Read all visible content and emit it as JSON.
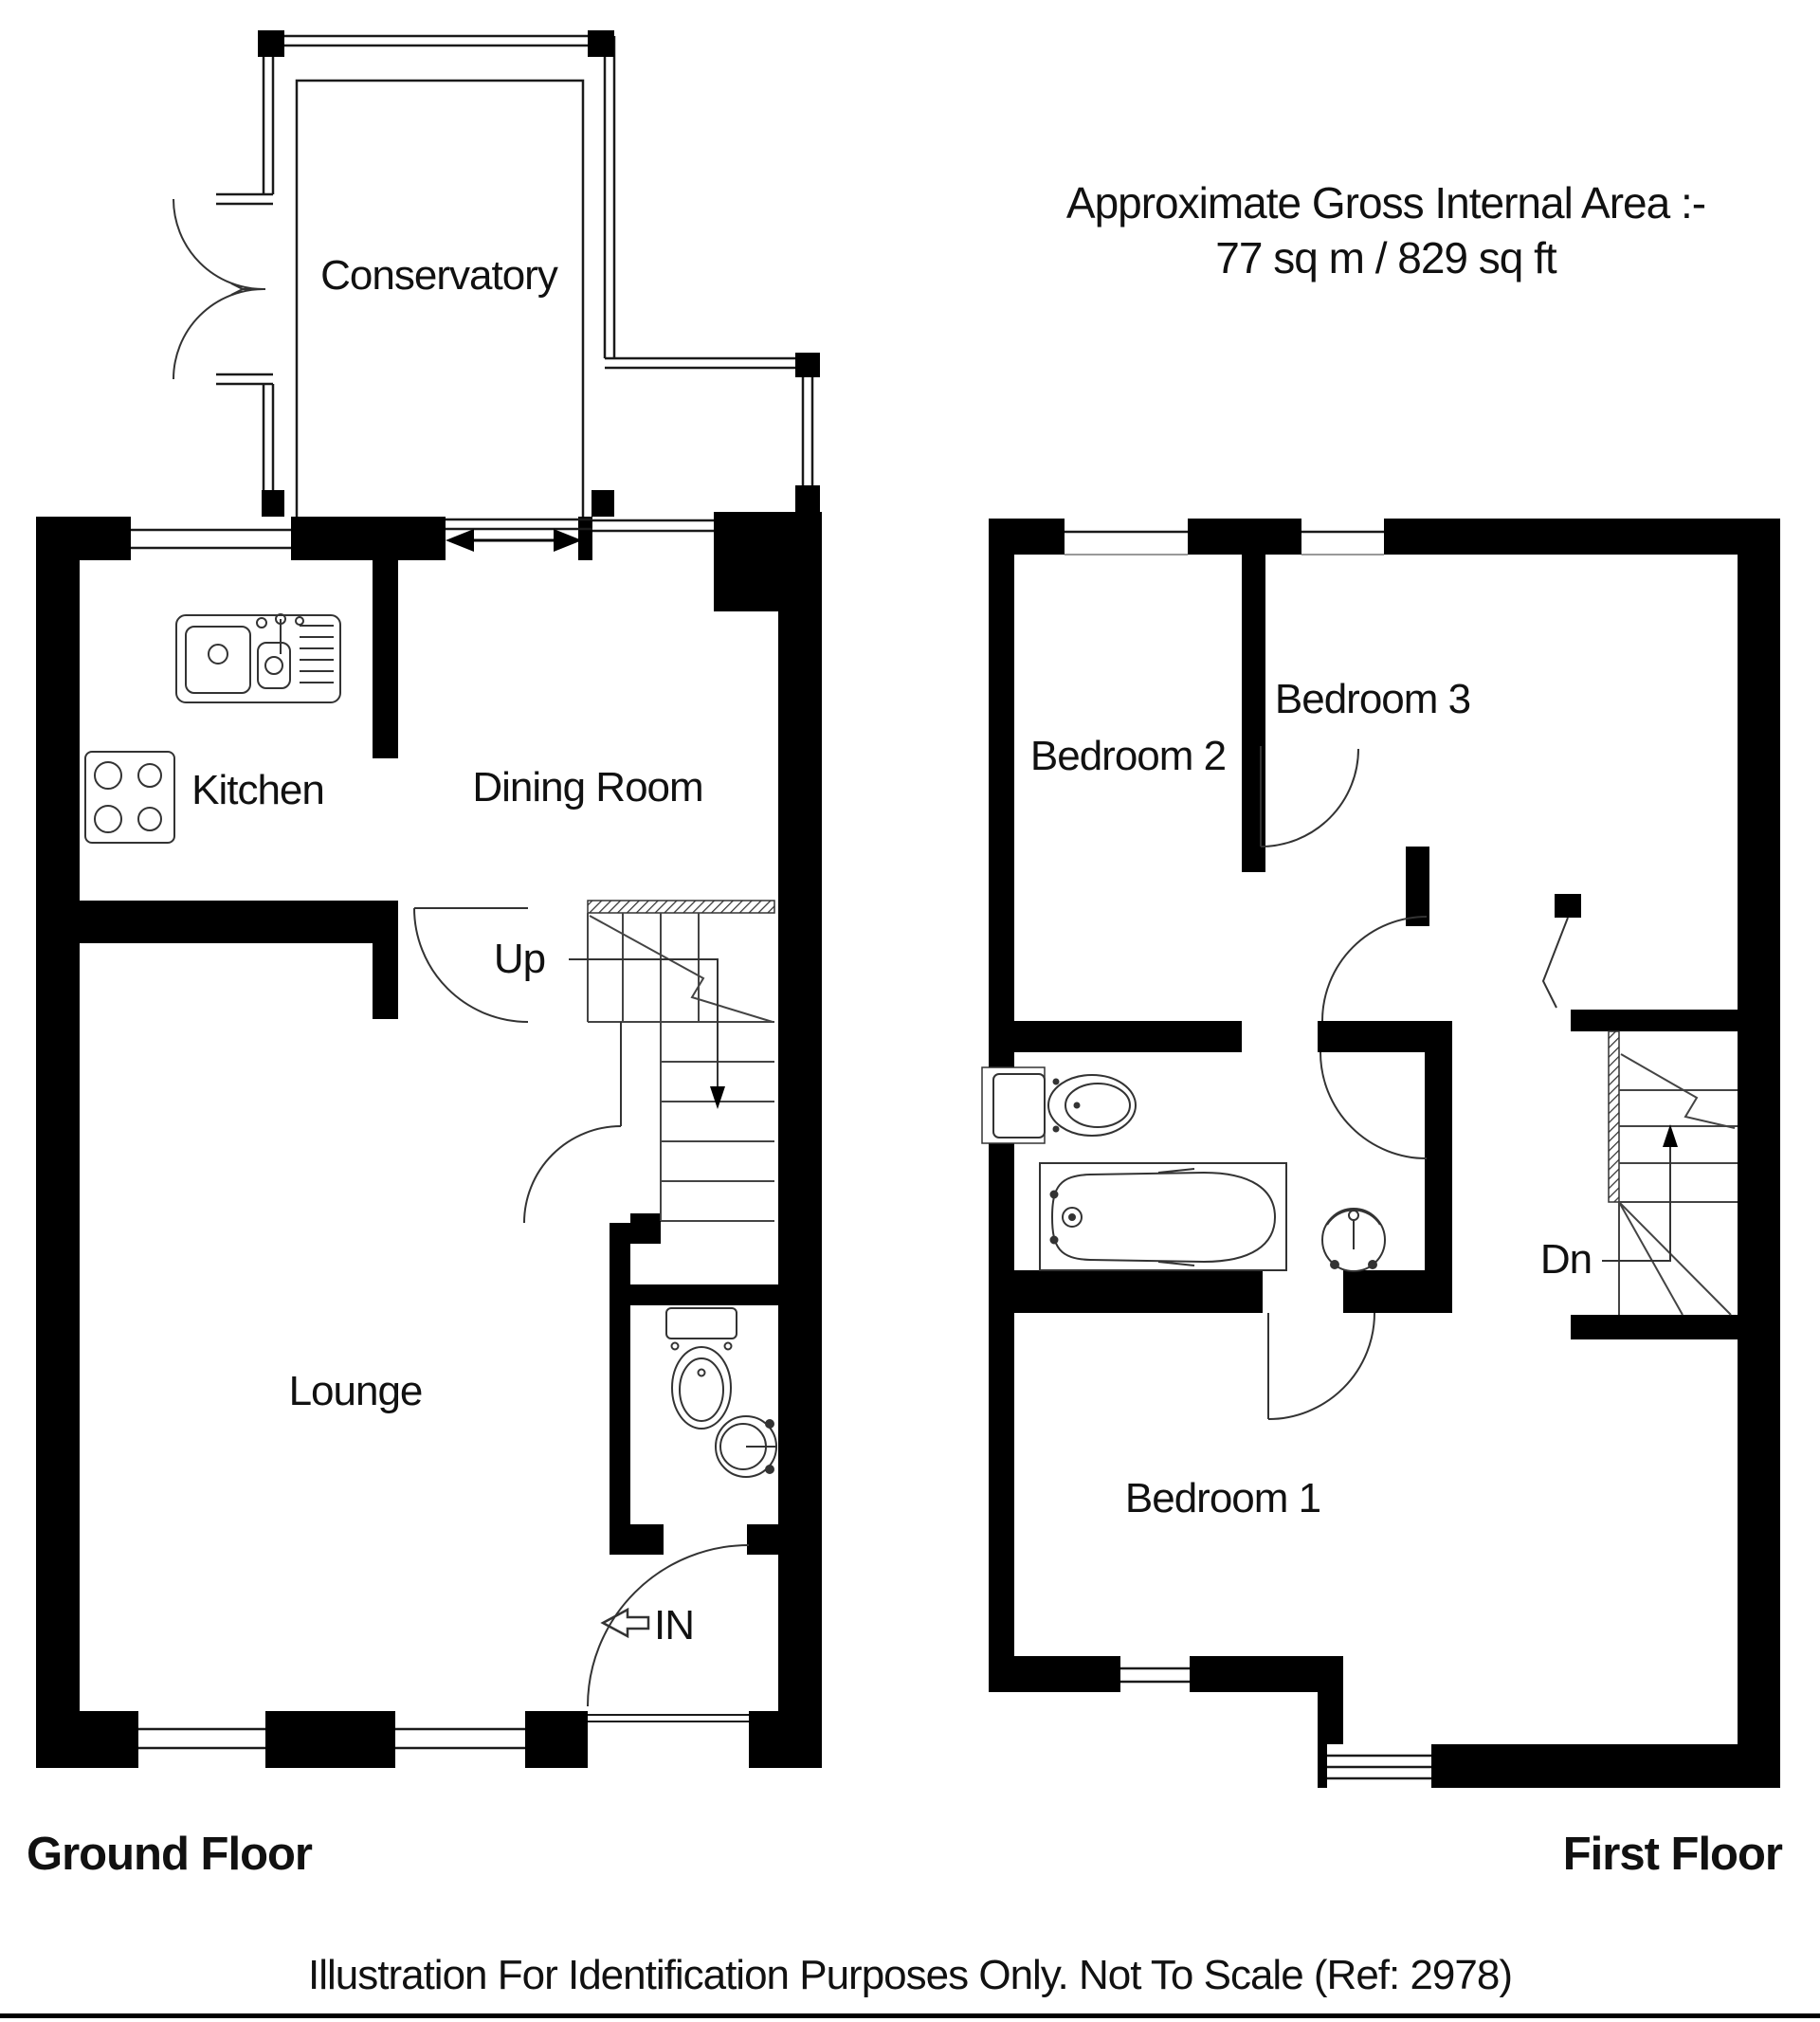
{
  "header": {
    "line1": "Approximate Gross Internal Area :-",
    "line2": "77 sq m / 829 sq ft"
  },
  "ground_floor": {
    "title": "Ground Floor",
    "rooms": {
      "conservatory": "Conservatory",
      "kitchen": "Kitchen",
      "dining_room": "Dining Room",
      "lounge": "Lounge"
    },
    "stairs_label": "Up",
    "entrance_label": "IN"
  },
  "first_floor": {
    "title": "First Floor",
    "rooms": {
      "bedroom1": "Bedroom 1",
      "bedroom2": "Bedroom 2",
      "bedroom3": "Bedroom 3"
    },
    "stairs_label": "Dn"
  },
  "footer": {
    "text": "Illustration For Identification Purposes Only. Not To Scale (Ref: 2978)"
  },
  "colors": {
    "wall": "#000000",
    "background": "#ffffff",
    "line": "#1a1a1a"
  }
}
